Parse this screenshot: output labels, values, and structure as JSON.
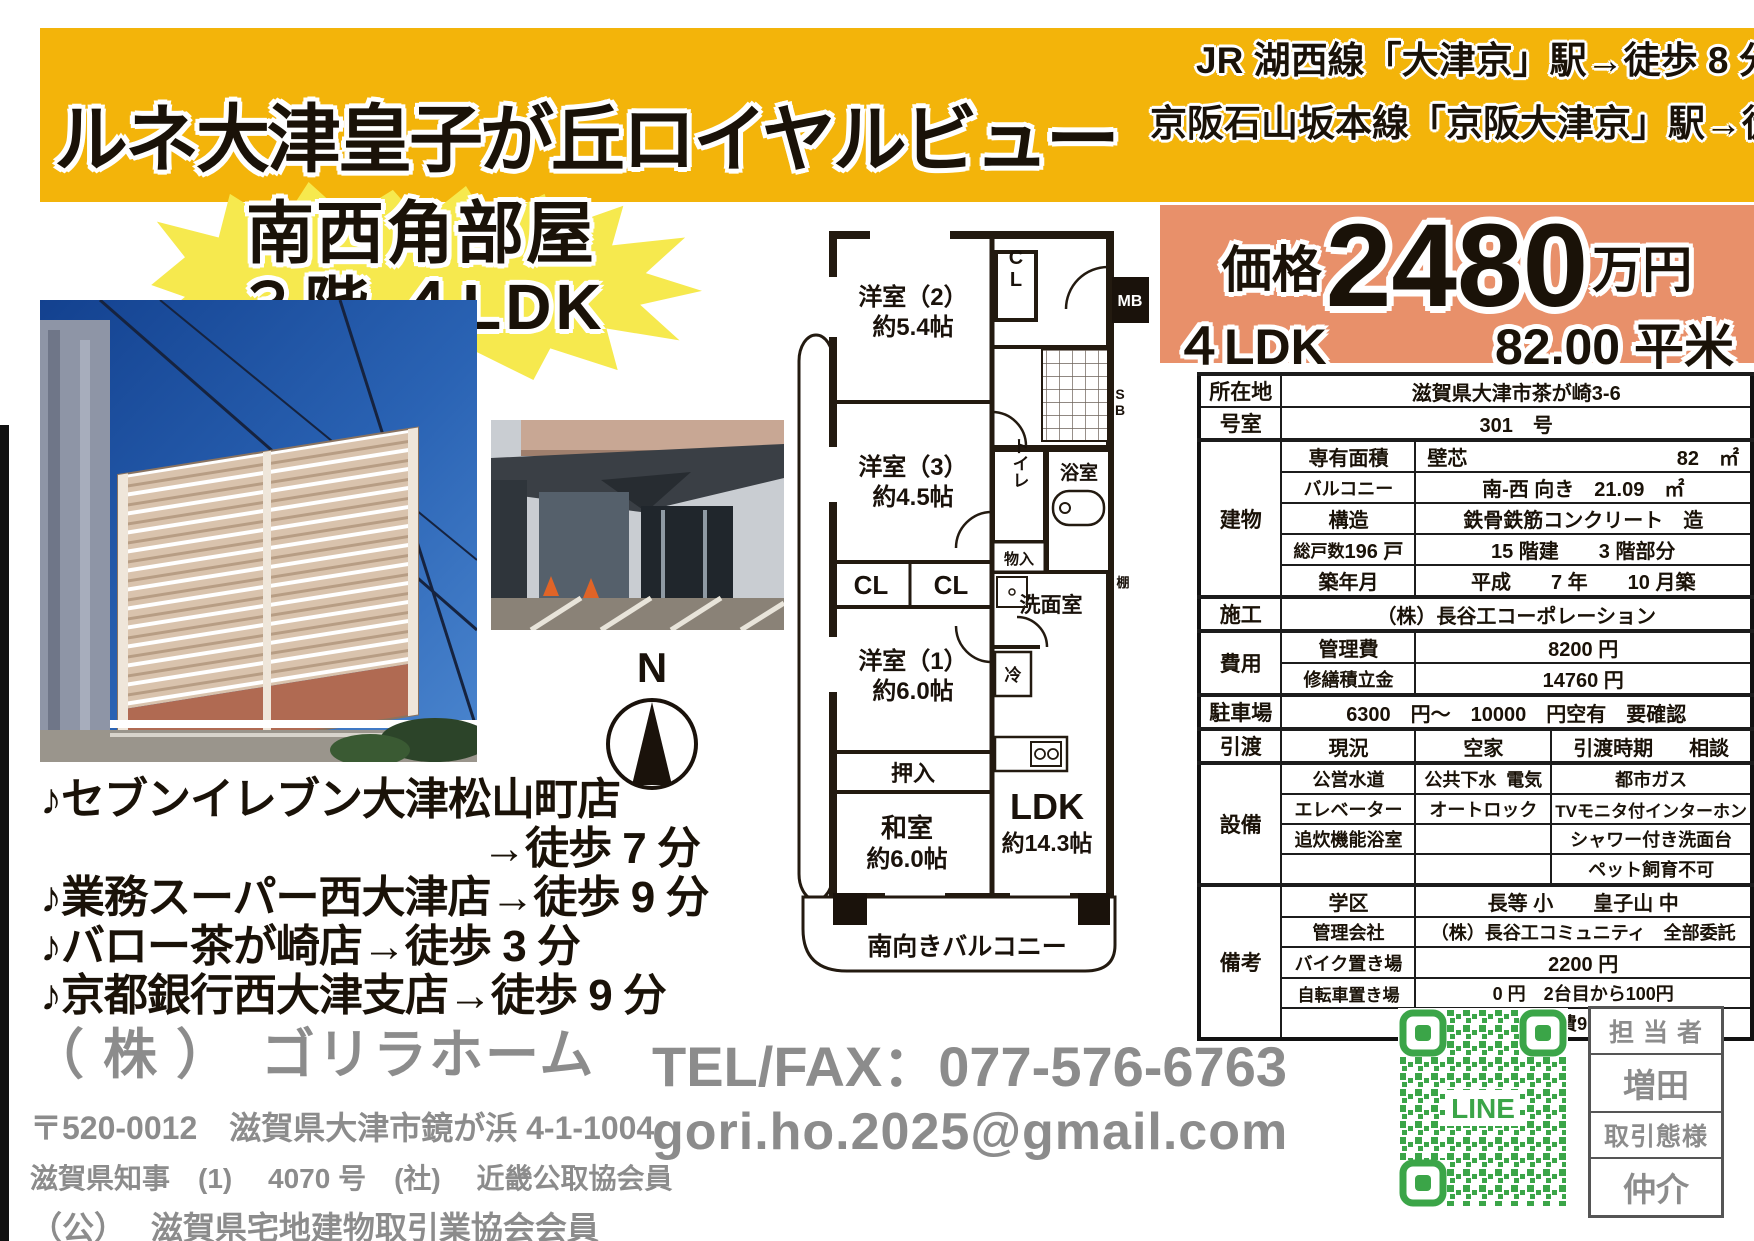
{
  "header": {
    "title": "ルネ大津皇子が丘ロイヤルビュー",
    "access_line1": "JR 湖西線「大津京」駅→徒歩 8 分",
    "access_line2": "京阪石山坂本線「京阪大津京」駅→徒歩 8 分"
  },
  "highlight": {
    "line1": "南西角部屋",
    "line2": "３階 ４LDK"
  },
  "price": {
    "label": "価格",
    "amount": "2480",
    "unit": "万円",
    "layout": "４LDK",
    "area": "82.00 平米"
  },
  "table": {
    "location_label": "所在地",
    "location": "滋賀県大津市茶が崎3-6",
    "room_label": "号室",
    "room": "301　号",
    "building_label": "建物",
    "senyu_label": "専有面積",
    "senyu_sub": "壁芯",
    "senyu_val": "82　㎡",
    "balcony_label": "バルコニー",
    "balcony_val": "南-西 向き　21.09　㎡",
    "kozo_label": "構造",
    "kozo_val": "鉄骨鉄筋コンクリート　造",
    "soukosu_label": "総戸数",
    "soukosu_val": "196 戸",
    "kaidate_val": "15 階建　　3 階部分",
    "chiku_label": "築年月",
    "chiku_val": "平成　　7 年　　10 月築",
    "seko_label": "施工",
    "seko_val": "（株）長谷工コーポレーション",
    "hiyo_label": "費用",
    "kanrihi_label": "管理費",
    "kanrihi_val": "8200 円",
    "shuzen_label": "修繕積立金",
    "shuzen_val": "14760 円",
    "parking_label": "駐車場",
    "parking_val": "6300　円～　10000　円空有　要確認",
    "hikiwatashi_label": "引渡",
    "genkyo_label": "現況",
    "genkyo_val": "空家",
    "jiki_label": "引渡時期",
    "jiki_val": "相談",
    "setsubi_label": "設備",
    "setsubi_r1": [
      "公営水道",
      "公共下水",
      "電気",
      "都市ガス"
    ],
    "setsubi_r2": [
      "エレベーター",
      "オートロック",
      "TVモニタ付インターホン"
    ],
    "setsubi_r3": [
      "追炊機能浴室",
      "",
      "シャワー付き洗面台"
    ],
    "setsubi_r4": [
      "",
      "",
      "ペット飼育不可"
    ],
    "biko_label": "備考",
    "gakku_label": "学区",
    "gakku_val": "長等 小　　皇子山 中",
    "kanri_label": "管理会社",
    "kanri_val": "（株）長谷工コミュニティ　全部委託",
    "bike_label": "バイク置き場",
    "bike_val": "2200 円",
    "bicycle_label": "自転車置き場",
    "bicycle_val": "0 円　2台目から100円",
    "jichikai_val": "自治会費900円／年"
  },
  "floorplan": {
    "y2": "洋室（2）",
    "y2_size": "約5.4帖",
    "y3": "洋室（3）",
    "y3_size": "約4.5帖",
    "y1": "洋室（1）",
    "y1_size": "約6.0帖",
    "washitsu": "和室",
    "washitsu_size": "約6.0帖",
    "ldk": "LDK",
    "ldk_size": "約14.3帖",
    "oshiire": "押入",
    "cl_a": "CL",
    "cl_b": "CL",
    "cl_c": "CL",
    "toilet": "トイレ",
    "monoire": "物入",
    "bath": "浴室",
    "senmenshitsu": "洗面室",
    "rei": "冷",
    "tana": "棚",
    "mb": "MB",
    "sb": "SB",
    "balcony": "南向きバルコニー",
    "compass_n": "N"
  },
  "amenities": [
    "♪セブンイレブン大津松山町店",
    "→徒歩 7 分",
    "♪業務スーパー西大津店→徒歩 9 分",
    "♪バロー茶が崎店→徒歩 3 分",
    "♪京都銀行西大津支店→徒歩 9 分"
  ],
  "company": {
    "name": "（ 株 ）　ゴリラホーム",
    "address": "〒520-0012　滋賀県大津市鏡が浜 4-1-1004",
    "license1": "滋賀県知事　(1)　 4070 号　(社)　 近畿公取協会員",
    "license2": "（公）　 滋賀県宅地建物取引業協会会員"
  },
  "contact": {
    "tel": "TEL/FAX：077-576-6763",
    "email": "gori.ho.2025@gmail.com",
    "qr_label": "LINE"
  },
  "agent": {
    "label1": "担 当 者",
    "name": "増田",
    "label2": "取引態様",
    "type": "仲介"
  }
}
